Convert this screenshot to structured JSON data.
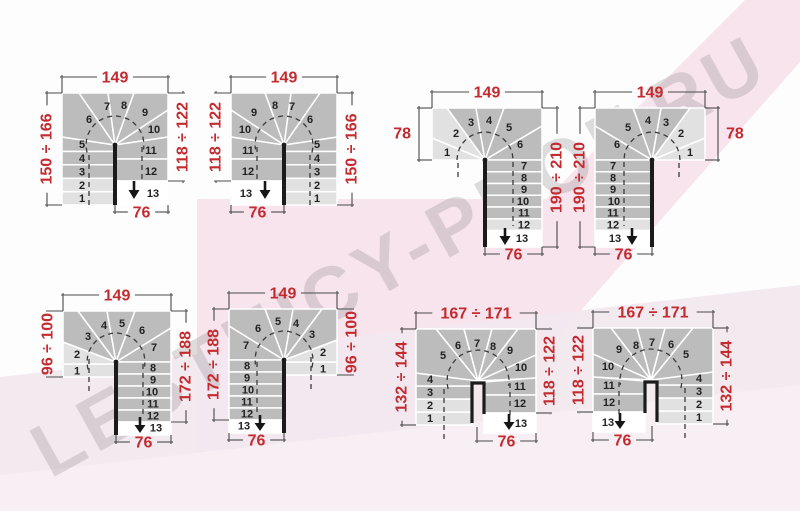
{
  "watermark": {
    "text": "LESTNICY-PROF.RU"
  },
  "colors": {
    "step_dark": "#bdbcbc",
    "step_light": "#e2e1e1",
    "step_white": "#ffffff",
    "separator": "#ffffff",
    "wall": "#1b1b1b",
    "arrow": "#161616",
    "step_number": "#222222",
    "dim_line": "#4a4a4a",
    "dim_red": "#c32b30",
    "walkline": "#3a3a3a",
    "bg_pink_main": "#f7e4ed",
    "bg_pink_band": "#f2e8ee",
    "bg_pink_light": "#f7eff3"
  },
  "step_numbers": [
    "1",
    "2",
    "3",
    "4",
    "5",
    "6",
    "7",
    "8",
    "9",
    "10",
    "11",
    "12",
    "13"
  ],
  "exit_arrow_step": "13",
  "diagrams": [
    {
      "id": "u-turn-left",
      "type": "A",
      "mirror": false,
      "origin": [
        62,
        93
      ],
      "dims": {
        "top": "149",
        "left": "150 ÷ 166",
        "right": "118 ÷ 122",
        "bottom": "76"
      }
    },
    {
      "id": "u-turn-right",
      "type": "A",
      "mirror": true,
      "origin": [
        231,
        93
      ],
      "dims": {
        "top": "149",
        "left": "118 ÷ 122",
        "right": "150 ÷ 166",
        "bottom": "76"
      }
    },
    {
      "id": "l-turn-left",
      "type": "B",
      "mirror": false,
      "origin": [
        432,
        108
      ],
      "dims": {
        "top": "149",
        "left": "78",
        "right": "190 ÷ 210",
        "bottom": "76"
      }
    },
    {
      "id": "l-turn-right",
      "type": "B",
      "mirror": true,
      "origin": [
        595,
        108
      ],
      "dims": {
        "top": "149",
        "left": "190 ÷ 210",
        "right": "78",
        "bottom": "76"
      }
    },
    {
      "id": "u-turn-long-left",
      "type": "C",
      "mirror": false,
      "origin": [
        63,
        311
      ],
      "dims": {
        "top": "149",
        "left": "96 ÷ 100",
        "right": "172 ÷ 188",
        "bottom": "76"
      }
    },
    {
      "id": "u-turn-long-right",
      "type": "C",
      "mirror": true,
      "origin": [
        229,
        309
      ],
      "dims": {
        "top": "149",
        "left": "172 ÷ 188",
        "right": "96 ÷ 100",
        "bottom": "76"
      }
    },
    {
      "id": "u-turn-wide-left",
      "type": "D",
      "mirror": false,
      "origin": [
        416,
        329
      ],
      "dims": {
        "top": "167 ÷ 171",
        "left": "132 ÷ 144",
        "right": "118 ÷ 122",
        "bottom": "76"
      }
    },
    {
      "id": "u-turn-wide-right",
      "type": "D",
      "mirror": true,
      "origin": [
        593,
        328
      ],
      "dims": {
        "top": "167 ÷ 171",
        "left": "118 ÷ 122",
        "right": "132 ÷ 144",
        "bottom": "76"
      }
    }
  ]
}
